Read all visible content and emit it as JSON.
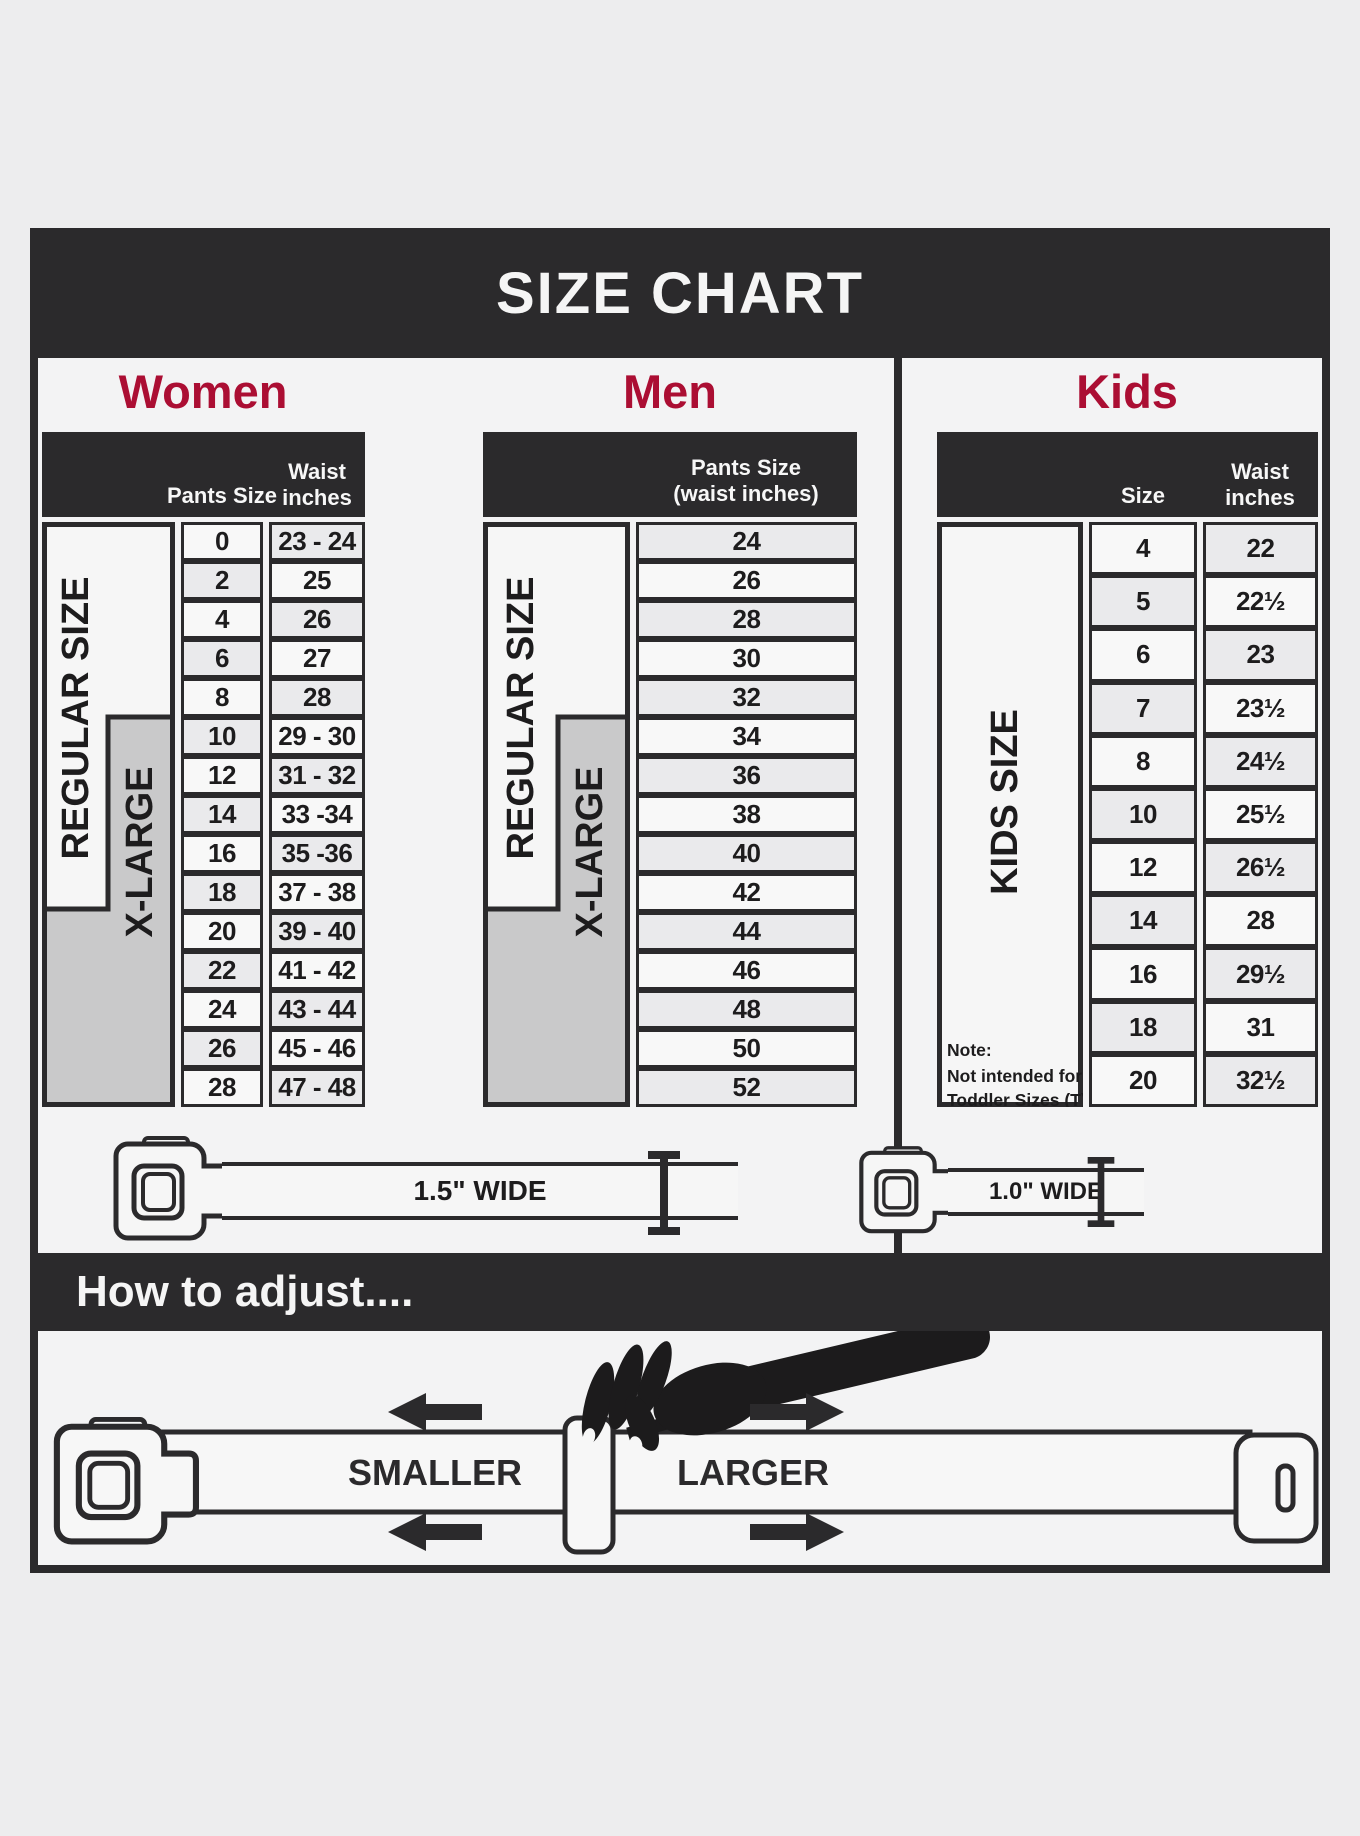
{
  "title": "SIZE CHART",
  "accent_color": "#ab0e33",
  "dark_color": "#2b2a2c",
  "sections": {
    "women": {
      "heading": "Women",
      "col1_header": "Pants Size",
      "col2_header_line1": "Waist",
      "col2_header_line2": "inches",
      "label_regular": "REGULAR SIZE",
      "label_xlarge": "X-LARGE",
      "rows": [
        {
          "pants": "0",
          "waist": "23 - 24"
        },
        {
          "pants": "2",
          "waist": "25"
        },
        {
          "pants": "4",
          "waist": "26"
        },
        {
          "pants": "6",
          "waist": "27"
        },
        {
          "pants": "8",
          "waist": "28"
        },
        {
          "pants": "10",
          "waist": "29 - 30"
        },
        {
          "pants": "12",
          "waist": "31 - 32"
        },
        {
          "pants": "14",
          "waist": "33 -34"
        },
        {
          "pants": "16",
          "waist": "35 -36"
        },
        {
          "pants": "18",
          "waist": "37 - 38"
        },
        {
          "pants": "20",
          "waist": "39 - 40"
        },
        {
          "pants": "22",
          "waist": "41 - 42"
        },
        {
          "pants": "24",
          "waist": "43 - 44"
        },
        {
          "pants": "26",
          "waist": "45 - 46"
        },
        {
          "pants": "28",
          "waist": "47 - 48"
        }
      ]
    },
    "men": {
      "heading": "Men",
      "col_header_line1": "Pants Size",
      "col_header_line2": "(waist inches)",
      "label_regular": "REGULAR SIZE",
      "label_xlarge": "X-LARGE",
      "rows": [
        {
          "size": "24"
        },
        {
          "size": "26"
        },
        {
          "size": "28"
        },
        {
          "size": "30"
        },
        {
          "size": "32"
        },
        {
          "size": "34"
        },
        {
          "size": "36"
        },
        {
          "size": "38"
        },
        {
          "size": "40"
        },
        {
          "size": "42"
        },
        {
          "size": "44"
        },
        {
          "size": "46"
        },
        {
          "size": "48"
        },
        {
          "size": "50"
        },
        {
          "size": "52"
        }
      ]
    },
    "kids": {
      "heading": "Kids",
      "col1_header": "Size",
      "col2_header_line1": "Waist",
      "col2_header_line2": "inches",
      "label": "KIDS SIZE",
      "note_line1": "Note:",
      "note_line2": "Not intended for",
      "note_line3": "Toddler Sizes (T)",
      "rows": [
        {
          "size": "4",
          "waist": "22"
        },
        {
          "size": "5",
          "waist": "22½"
        },
        {
          "size": "6",
          "waist": "23"
        },
        {
          "size": "7",
          "waist": "23½"
        },
        {
          "size": "8",
          "waist": "24½"
        },
        {
          "size": "10",
          "waist": "25½"
        },
        {
          "size": "12",
          "waist": "26½"
        },
        {
          "size": "14",
          "waist": "28"
        },
        {
          "size": "16",
          "waist": "29½"
        },
        {
          "size": "18",
          "waist": "31"
        },
        {
          "size": "20",
          "waist": "32½"
        }
      ]
    }
  },
  "belts": {
    "adult_width_label": "1.5\" WIDE",
    "kids_width_label": "1.0\" WIDE"
  },
  "how_to_adjust": {
    "heading": "How to adjust....",
    "smaller_label": "SMALLER",
    "larger_label": "LARGER"
  }
}
